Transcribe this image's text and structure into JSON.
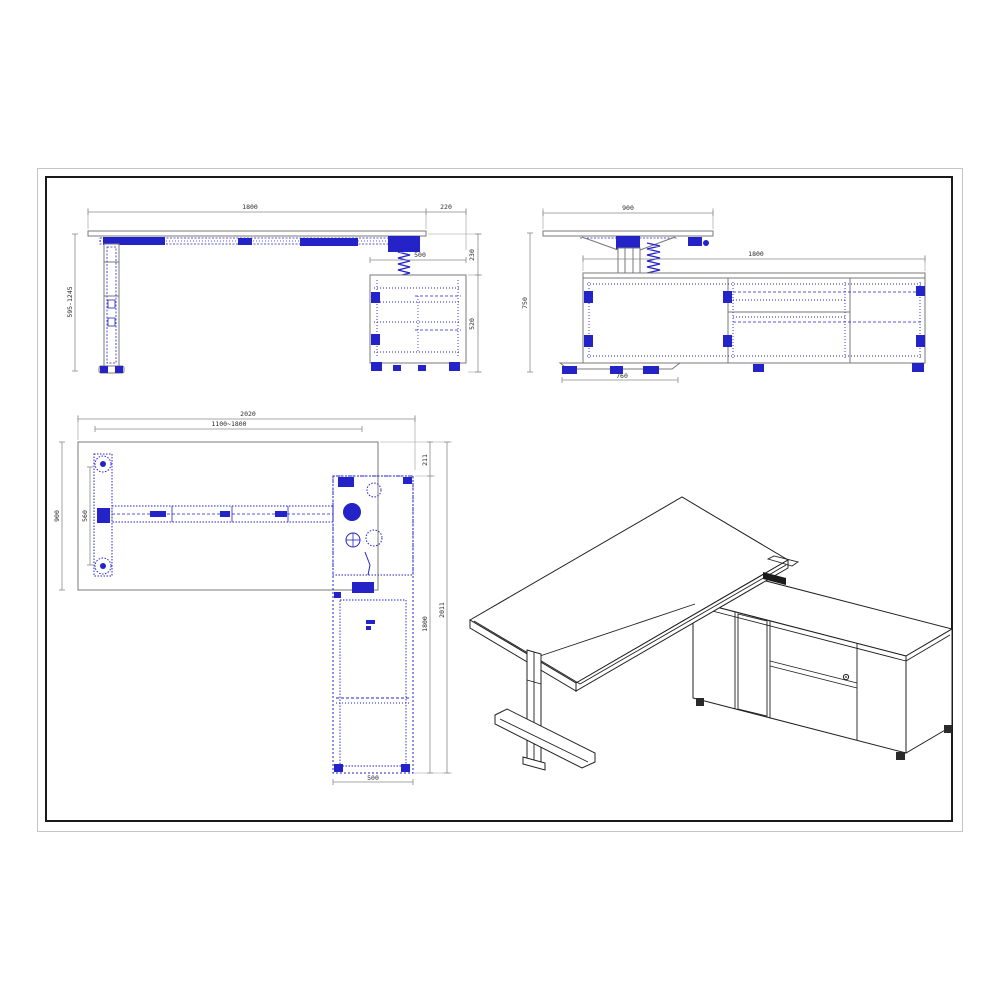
{
  "sheet": {
    "background": "#ffffff",
    "border_outer_color": "#c4c4c4",
    "border_inner_color": "#1a1a1a",
    "blueprint_color": "#2323c8",
    "outline_color": "#787878",
    "dimension_line_color": "#8a8a8a"
  },
  "views": {
    "front": {
      "title": "front-elevation",
      "dims": {
        "desk_width": "1800",
        "overhang": "220",
        "cabinet_width": "500",
        "height_range": "595-1245",
        "top_to_cabinet": "230",
        "cabinet_height": "520"
      }
    },
    "side": {
      "title": "side-elevation",
      "dims": {
        "desk_depth": "900",
        "cabinet_length": "1800",
        "desk_height": "750",
        "foot_length": "760"
      }
    },
    "plan": {
      "title": "plan-view",
      "dims": {
        "total_width": "2020",
        "adjustable_width": "1100~1800",
        "desk_depth": "900",
        "foot_span": "560",
        "corner_offset": "211",
        "cabinet_length": "1800",
        "total_depth": "2011",
        "cabinet_depth": "500"
      }
    },
    "iso": {
      "title": "isometric-view"
    }
  }
}
